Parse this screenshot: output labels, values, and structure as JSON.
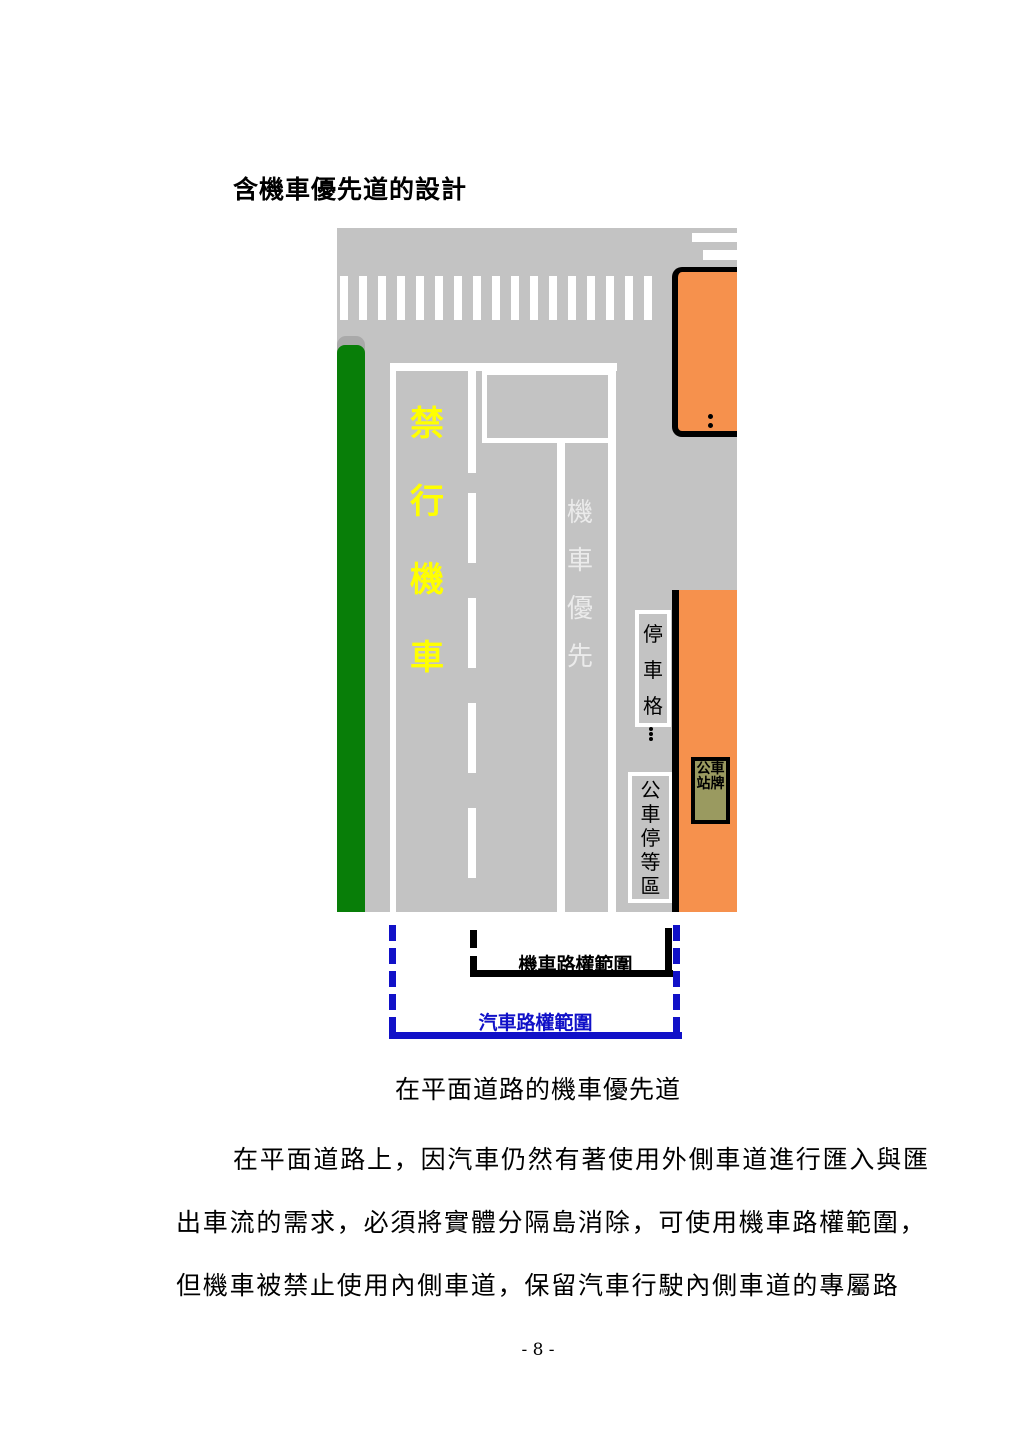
{
  "document": {
    "title": "含機車優先道的設計",
    "figure_caption": "在平面道路的機車優先道",
    "body_lines": [
      "在平面道路上，因汽車仍然有著使用外側車道進行匯入與匯",
      "出車流的需求，必須將實體分隔島消除，可使用機車路權範圍，",
      "但機車被禁止使用內側車道，保留汽車行駛內側車道的專屬路"
    ],
    "page_number": "- 8 -"
  },
  "diagram": {
    "labels": {
      "prohibited_lane": "禁行機車",
      "priority_lane": "機車優先",
      "parking_space": "停車格",
      "bus_wait_area": "公車停等區",
      "bus_stop_sign": "公車站牌",
      "moto_right_of_way": "機車路權範圍",
      "car_right_of_way": "汽車路權範圍"
    },
    "colors": {
      "road_gray": "#c3c3c3",
      "median_green": "#087e08",
      "sidewalk_orange": "#f6914d",
      "bus_sign_olive": "#9a9a60",
      "lane_marking_white": "#ffffff",
      "prohibited_text_yellow": "#ffff00",
      "priority_text_white": "#ebebeb",
      "car_bracket_blue": "#1111c8",
      "moto_bracket_black": "#000000"
    }
  }
}
